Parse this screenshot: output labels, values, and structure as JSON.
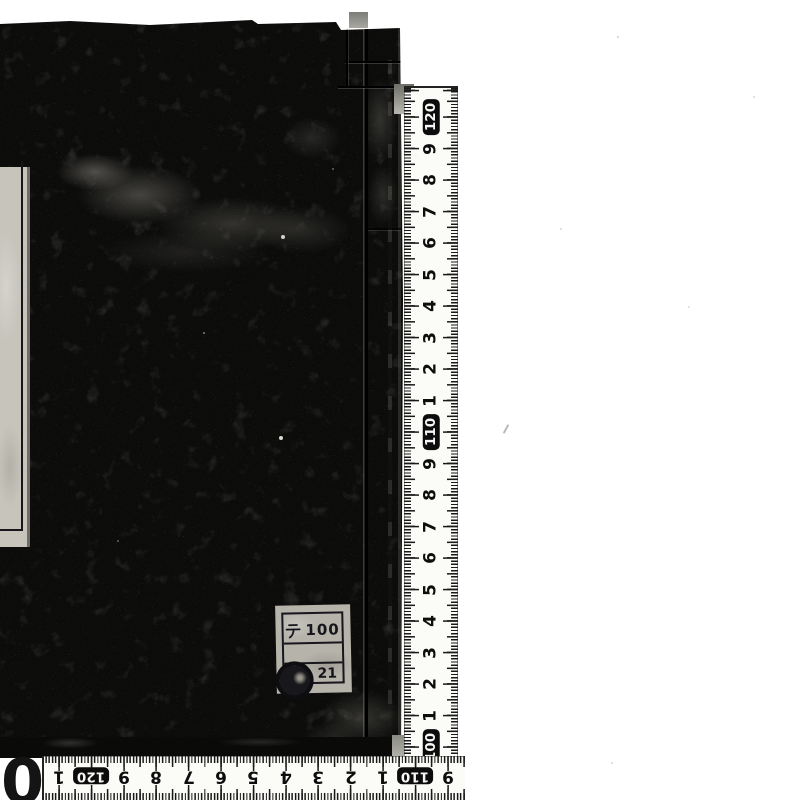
{
  "scan": {
    "background_color": "#ffffff",
    "book": {
      "cover_color": "#0c0c0b",
      "call_number_label": {
        "row1_prefix": "テ",
        "row1_number": "100",
        "row2_number": "21",
        "stamp": "circular-library-seal",
        "label_color": "#b5b3aa",
        "border_color": "#16161c"
      },
      "title_slip_color": "#c6c4bb"
    },
    "rulers": {
      "tick_color": "#191919",
      "tape_color": "#fbfbf8",
      "boxed_values": [
        "120",
        "110",
        "100"
      ],
      "vertical": {
        "orientation": "right-edge, values descend downward",
        "labels": [
          "120",
          "9",
          "8",
          "7",
          "6",
          "5",
          "4",
          "3",
          "2",
          "1",
          "110",
          "9",
          "8",
          "7",
          "6",
          "5",
          "4",
          "3",
          "2",
          "1",
          "100"
        ],
        "start": 29,
        "step": 31.5,
        "cross": 27
      },
      "horizontal": {
        "orientation": "bottom-edge, numbers upside down, values descend rightward",
        "labels": [
          "1",
          "120",
          "9",
          "8",
          "7",
          "6",
          "5",
          "4",
          "3",
          "2",
          "1",
          "110",
          "9"
        ],
        "start": 15,
        "step": 32.4,
        "cross": 20
      },
      "corner_digit": "0"
    }
  }
}
